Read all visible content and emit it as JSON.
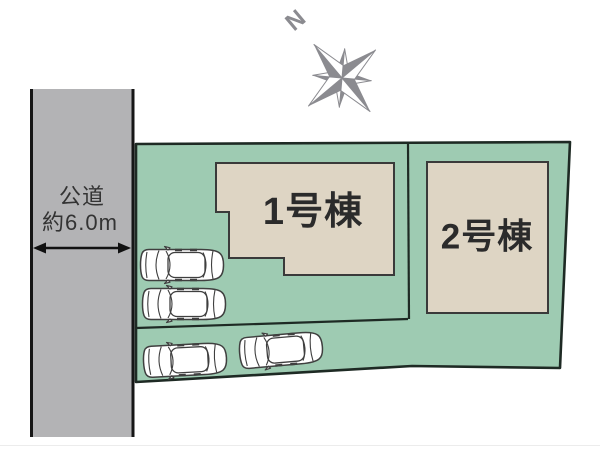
{
  "road": {
    "name": "公道",
    "width": "約6.0m"
  },
  "compass": {
    "north": "N"
  },
  "plot": {
    "building1_label": "1号棟",
    "building2_label": "2号棟"
  },
  "icons": {
    "compass": "compass-rose",
    "car": "car-top-view",
    "road_width_arrow": "double-headed-arrow"
  },
  "colors": {
    "plot_green": "#9ecbb2",
    "plot_outline": "#1e2a24",
    "building_fill": "#ded5c4",
    "building_outline": "#3a3a3a",
    "road_gray": "#b3b3b5",
    "road_edge": "#161616",
    "text_dark": "#333333",
    "building_text": "#2b2b2b",
    "compass_gray": "#8b8b90",
    "car_outline": "#3f3f3f"
  }
}
